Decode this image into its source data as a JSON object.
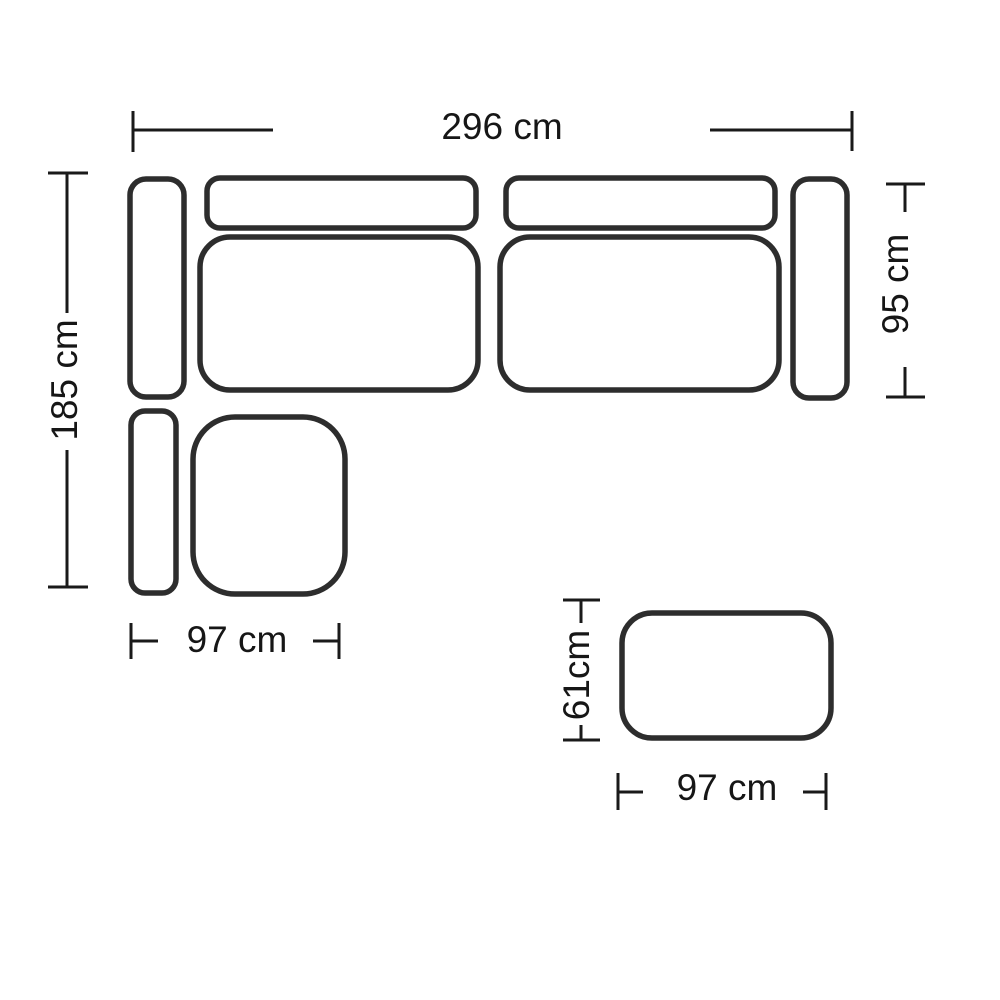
{
  "diagram": {
    "kind": "corner-sofa-floorplan-with-ottoman",
    "unit": "cm",
    "dimensions": {
      "total_width": {
        "value": 296,
        "label": "296 cm"
      },
      "left_depth": {
        "value": 185,
        "label": "185 cm"
      },
      "right_depth": {
        "value": 95,
        "label": "95 cm"
      },
      "corner_width": {
        "value": 97,
        "label": "97 cm"
      },
      "ottoman_depth": {
        "value": 61,
        "label": "61cm"
      },
      "ottoman_width": {
        "value": 97,
        "label": "97 cm"
      }
    },
    "parts": [
      "armrest-left-upper",
      "armrest-left-lower",
      "backrest-left",
      "backrest-right",
      "seat-left",
      "seat-right",
      "armrest-right",
      "corner-seat",
      "ottoman"
    ],
    "colors": {
      "background": "#ffffff",
      "outline": "#2d2d2d",
      "dimension_lines": "#1a1a1a",
      "label_text": "#161616"
    }
  }
}
